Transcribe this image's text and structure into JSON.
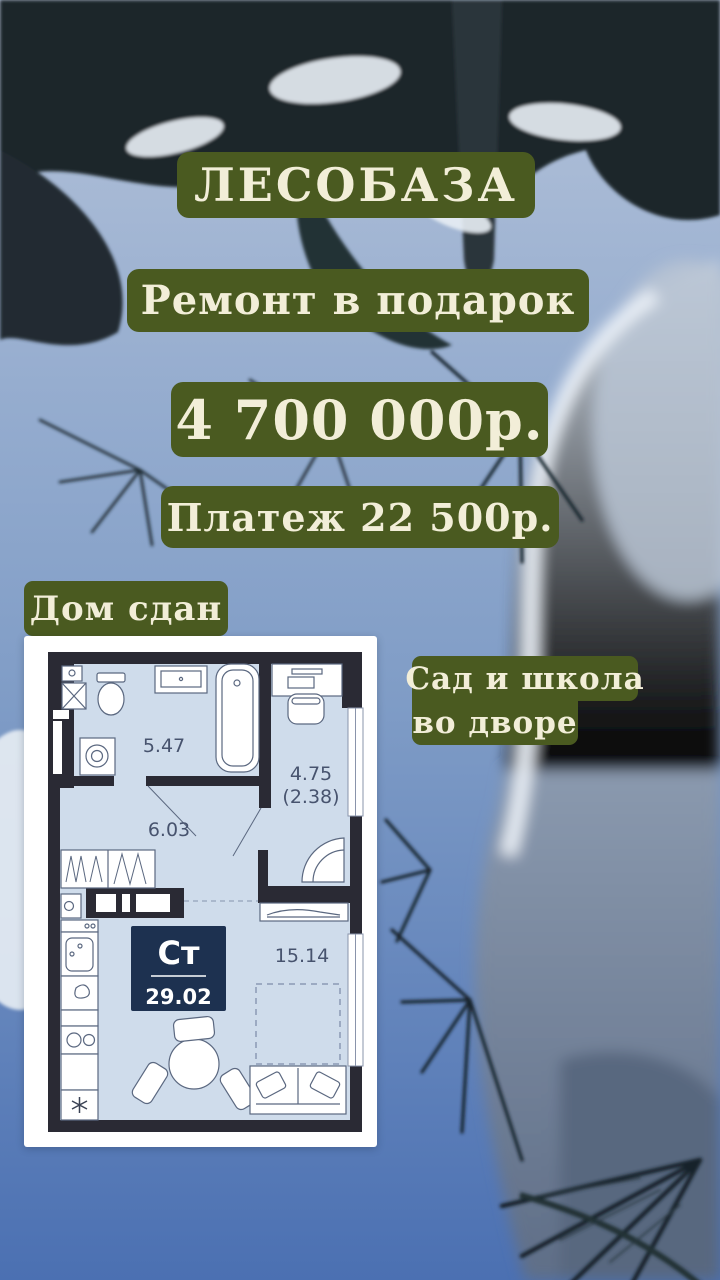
{
  "canvas": {
    "width": 720,
    "height": 1280
  },
  "colors": {
    "highlight_green": "#4a5a20",
    "text_cream": "#f2eed8",
    "sky_bottom_blue": "#4b70b2",
    "plan_wall": "#2a2a34",
    "plan_floor": "#cfdceb",
    "plan_badge_navy": "#1d3150",
    "plan_label_text": "#47536e"
  },
  "overlay": {
    "title": "ЛЕСОБАЗА",
    "offer": "Ремонт в подарок",
    "price": "4 700 000р.",
    "payment": "Платеж 22 500р.",
    "status": "Дом сдан",
    "amenity_line1": "Сад и школа",
    "amenity_line2": "во дворе"
  },
  "floorplan": {
    "unit_type_label": "Ст",
    "total_area": "29.02",
    "rooms": {
      "bathroom": "5.47",
      "hallway": "6.03",
      "loggia": "4.75",
      "loggia_reduced": "(2.38)",
      "living_room": "15.14"
    }
  }
}
